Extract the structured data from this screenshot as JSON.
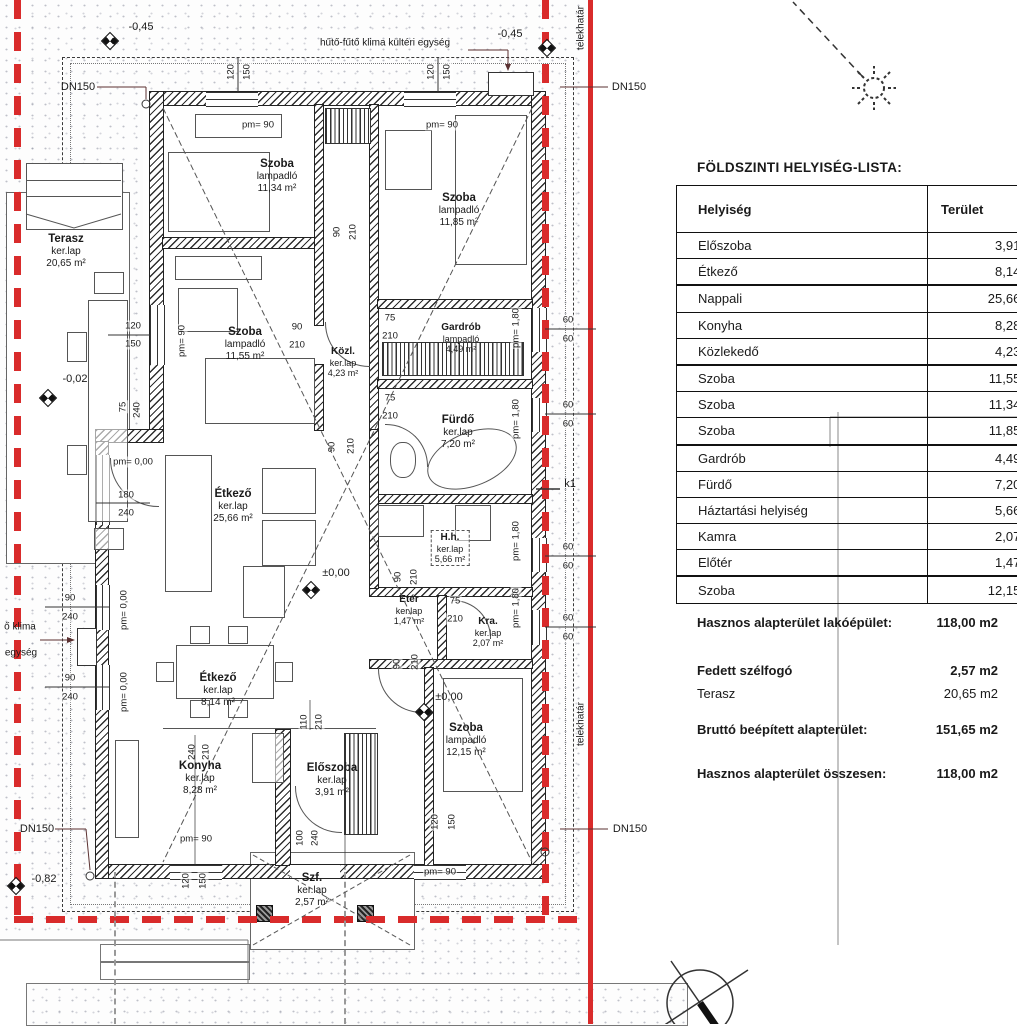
{
  "colors": {
    "boundary_red": "#d92b2b",
    "wall_dark": "#222222",
    "texture_gray": "#737a8a"
  },
  "plan": {
    "rooms": [
      {
        "name": "Terasz",
        "floor": "ker.lap",
        "area": "20,65 m²",
        "x": 66,
        "y": 233,
        "cls": ""
      },
      {
        "name": "Szoba",
        "floor": "lampadló",
        "area": "11,34 m²",
        "x": 277,
        "y": 158,
        "cls": ""
      },
      {
        "name": "Szoba",
        "floor": "lampadló",
        "area": "11,85 m²",
        "x": 459,
        "y": 192,
        "cls": ""
      },
      {
        "name": "Szoba",
        "floor": "lampadló",
        "area": "11,55 m²",
        "x": 245,
        "y": 326,
        "cls": ""
      },
      {
        "name": "Közl.",
        "floor": "ker.lap",
        "area": "4,23 m²",
        "x": 343,
        "y": 346,
        "cls": "sm"
      },
      {
        "name": "Gardrób",
        "floor": "lampadló",
        "area": "4,49 m²",
        "x": 461,
        "y": 322,
        "cls": "sm"
      },
      {
        "name": "Fürdő",
        "floor": "ker.lap",
        "area": "7,20 m²",
        "x": 458,
        "y": 414,
        "cls": ""
      },
      {
        "name": "H.h.",
        "floor": "ker.lap",
        "area": "5,66 m²",
        "x": 450,
        "y": 530,
        "cls": "sm dashedbox"
      },
      {
        "name": "Étkező",
        "floor": "ker.lap",
        "area": "25,66 m²",
        "x": 233,
        "y": 488,
        "cls": ""
      },
      {
        "name": "Etér",
        "floor": "ker.lap",
        "area": "1,47 m²",
        "x": 409,
        "y": 594,
        "cls": "sm"
      },
      {
        "name": "Kra.",
        "floor": "ker.lap",
        "area": "2,07 m²",
        "x": 488,
        "y": 616,
        "cls": "sm"
      },
      {
        "name": "Étkező",
        "floor": "ker.lap",
        "area": "8,14 m²",
        "x": 218,
        "y": 672,
        "cls": ""
      },
      {
        "name": "Konyha",
        "floor": "ker.lap",
        "area": "8,28 m²",
        "x": 200,
        "y": 760,
        "cls": ""
      },
      {
        "name": "Előszoba",
        "floor": "ker.lap",
        "area": "3,91 m²",
        "x": 332,
        "y": 762,
        "cls": ""
      },
      {
        "name": "Szoba",
        "floor": "lampadló",
        "area": "12,15 m²",
        "x": 466,
        "y": 722,
        "cls": ""
      },
      {
        "name": "Szf.",
        "floor": "ker.lap",
        "area": "2,57 m²",
        "x": 312,
        "y": 872,
        "cls": ""
      }
    ],
    "annotations": [
      {
        "t": "hűtő-fűtő klima kültéri egység",
        "x": 385,
        "y": 43,
        "r": 0,
        "cls": "smtxt"
      },
      {
        "t": "DN150",
        "x": 78,
        "y": 87,
        "r": 0,
        "cls": ""
      },
      {
        "t": "DN150",
        "x": 629,
        "y": 87,
        "r": 0,
        "cls": ""
      },
      {
        "t": "DN150",
        "x": 37,
        "y": 829,
        "r": 0,
        "cls": ""
      },
      {
        "t": "DN150",
        "x": 630,
        "y": 829,
        "r": 0,
        "cls": ""
      },
      {
        "t": "-0,45",
        "x": 141,
        "y": 27,
        "r": 0,
        "cls": ""
      },
      {
        "t": "-0,45",
        "x": 510,
        "y": 34,
        "r": 0,
        "cls": ""
      },
      {
        "t": "-0,02",
        "x": 75,
        "y": 379,
        "r": 0,
        "cls": ""
      },
      {
        "t": "-0,82",
        "x": 44,
        "y": 879,
        "r": 0,
        "cls": ""
      },
      {
        "t": "±0,00",
        "x": 336,
        "y": 573,
        "r": 0,
        "cls": ""
      },
      {
        "t": "±0,00",
        "x": 449,
        "y": 697,
        "r": 0,
        "cls": ""
      },
      {
        "t": "k1",
        "x": 570,
        "y": 484,
        "r": 0,
        "cls": ""
      },
      {
        "t": "ő klima",
        "x": 20,
        "y": 627,
        "r": 0,
        "cls": "smtxt"
      },
      {
        "t": "egység",
        "x": 21,
        "y": 653,
        "r": 0,
        "cls": "smtxt"
      },
      {
        "t": "telekhatár",
        "x": 581,
        "y": 724,
        "r": -90,
        "cls": "smtxt"
      },
      {
        "t": "telekhatár",
        "x": 581,
        "y": 28,
        "r": -90,
        "cls": "smtxt"
      }
    ],
    "dims": [
      {
        "t": "120",
        "x": 231,
        "y": 72,
        "r": -90
      },
      {
        "t": "150",
        "x": 247,
        "y": 72,
        "r": -90
      },
      {
        "t": "120",
        "x": 431,
        "y": 72,
        "r": -90
      },
      {
        "t": "150",
        "x": 447,
        "y": 72,
        "r": -90
      },
      {
        "t": "pm= 90",
        "x": 258,
        "y": 125,
        "r": 0
      },
      {
        "t": "pm= 90",
        "x": 442,
        "y": 125,
        "r": 0
      },
      {
        "t": "90",
        "x": 337,
        "y": 232,
        "r": -90
      },
      {
        "t": "210",
        "x": 353,
        "y": 232,
        "r": -90
      },
      {
        "t": "90",
        "x": 297,
        "y": 327,
        "r": 0
      },
      {
        "t": "210",
        "x": 297,
        "y": 345,
        "r": 0
      },
      {
        "t": "75",
        "x": 390,
        "y": 318,
        "r": 0
      },
      {
        "t": "210",
        "x": 390,
        "y": 336,
        "r": 0
      },
      {
        "t": "75",
        "x": 390,
        "y": 398,
        "r": 0
      },
      {
        "t": "210",
        "x": 390,
        "y": 416,
        "r": 0
      },
      {
        "t": "90",
        "x": 332,
        "y": 447,
        "r": -90
      },
      {
        "t": "210",
        "x": 351,
        "y": 446,
        "r": -90
      },
      {
        "t": "90",
        "x": 398,
        "y": 577,
        "r": -90
      },
      {
        "t": "210",
        "x": 414,
        "y": 577,
        "r": -90
      },
      {
        "t": "90",
        "x": 397,
        "y": 664,
        "r": -90
      },
      {
        "t": "210",
        "x": 415,
        "y": 662,
        "r": -90
      },
      {
        "t": "75",
        "x": 455,
        "y": 601,
        "r": 0
      },
      {
        "t": "210",
        "x": 455,
        "y": 619,
        "r": 0
      },
      {
        "t": "pm= 90",
        "x": 182,
        "y": 341,
        "r": -90
      },
      {
        "t": "120",
        "x": 133,
        "y": 326,
        "r": 0
      },
      {
        "t": "150",
        "x": 133,
        "y": 344,
        "r": 0
      },
      {
        "t": "75",
        "x": 123,
        "y": 407,
        "r": -90
      },
      {
        "t": "240",
        "x": 137,
        "y": 410,
        "r": -90
      },
      {
        "t": "pm= 0,00",
        "x": 133,
        "y": 462,
        "r": 0
      },
      {
        "t": "180",
        "x": 126,
        "y": 495,
        "r": 0
      },
      {
        "t": "240",
        "x": 126,
        "y": 513,
        "r": 0
      },
      {
        "t": "90",
        "x": 70,
        "y": 598,
        "r": 0
      },
      {
        "t": "240",
        "x": 70,
        "y": 617,
        "r": 0
      },
      {
        "t": "pm= 0,00",
        "x": 124,
        "y": 610,
        "r": -90
      },
      {
        "t": "90",
        "x": 70,
        "y": 678,
        "r": 0
      },
      {
        "t": "240",
        "x": 70,
        "y": 697,
        "r": 0
      },
      {
        "t": "pm= 0,00",
        "x": 124,
        "y": 692,
        "r": -90
      },
      {
        "t": "240",
        "x": 192,
        "y": 752,
        "r": -90
      },
      {
        "t": "210",
        "x": 206,
        "y": 752,
        "r": -90
      },
      {
        "t": "110",
        "x": 304,
        "y": 722,
        "r": -90
      },
      {
        "t": "210",
        "x": 319,
        "y": 722,
        "r": -90
      },
      {
        "t": "100",
        "x": 300,
        "y": 838,
        "r": -90
      },
      {
        "t": "240",
        "x": 315,
        "y": 838,
        "r": -90
      },
      {
        "t": "120",
        "x": 186,
        "y": 881,
        "r": -90
      },
      {
        "t": "150",
        "x": 203,
        "y": 881,
        "r": -90
      },
      {
        "t": "120",
        "x": 435,
        "y": 822,
        "r": -90
      },
      {
        "t": "150",
        "x": 452,
        "y": 822,
        "r": -90
      },
      {
        "t": "pm= 90",
        "x": 196,
        "y": 839,
        "r": 0
      },
      {
        "t": "pm= 90",
        "x": 440,
        "y": 872,
        "r": 0
      },
      {
        "t": "pm= 1,80",
        "x": 516,
        "y": 328,
        "r": -90
      },
      {
        "t": "pm= 1,80",
        "x": 516,
        "y": 419,
        "r": -90
      },
      {
        "t": "pm= 1,80",
        "x": 516,
        "y": 541,
        "r": -90
      },
      {
        "t": "pm= 1,80",
        "x": 516,
        "y": 608,
        "r": -90
      },
      {
        "t": "60",
        "x": 568,
        "y": 320,
        "r": 0
      },
      {
        "t": "60",
        "x": 568,
        "y": 339,
        "r": 0
      },
      {
        "t": "60",
        "x": 568,
        "y": 405,
        "r": 0
      },
      {
        "t": "60",
        "x": 568,
        "y": 424,
        "r": 0
      },
      {
        "t": "60",
        "x": 568,
        "y": 547,
        "r": 0
      },
      {
        "t": "60",
        "x": 568,
        "y": 566,
        "r": 0
      },
      {
        "t": "60",
        "x": 568,
        "y": 618,
        "r": 0
      },
      {
        "t": "60",
        "x": 568,
        "y": 637,
        "r": 0
      }
    ]
  },
  "table": {
    "title": "FÖLDSZINTI HELYISÉG-LISTA:",
    "col_room": "Helyiség",
    "col_area": "Terület",
    "rows": [
      {
        "name": "Előszoba",
        "area": "3,91 m2",
        "thick": false
      },
      {
        "name": "Étkező",
        "area": "8,14 m2",
        "thick": true
      },
      {
        "name": "Nappali",
        "area": "25,66 m2",
        "thick": false
      },
      {
        "name": "Konyha",
        "area": "8,28 m2",
        "thick": false
      },
      {
        "name": "Közlekedő",
        "area": "4,23 m2",
        "thick": true
      },
      {
        "name": "Szoba",
        "area": "11,55 m2",
        "thick": false
      },
      {
        "name": "Szoba",
        "area": "11,34 m2",
        "thick": false
      },
      {
        "name": "Szoba",
        "area": "11,85 m2",
        "thick": true
      },
      {
        "name": "Gardrób",
        "area": "4,49 m2",
        "thick": false
      },
      {
        "name": "Fürdő",
        "area": "7,20 m2",
        "thick": false
      },
      {
        "name": "Háztartási helyiség",
        "area": "5,66 m2",
        "thick": false
      },
      {
        "name": "Kamra",
        "area": "2,07 m2",
        "thick": false
      },
      {
        "name": "Előtér",
        "area": "1,47 m2",
        "thick": true
      },
      {
        "name": "Szoba",
        "area": "12,15 m2",
        "thick": false
      }
    ],
    "summary": [
      {
        "label": "Hasznos alapterület lakóépület:",
        "value": "118,00 m2",
        "bold": true,
        "y": 615
      },
      {
        "label": "Fedett szélfogó",
        "value": "2,57 m2",
        "bold": true,
        "y": 663
      },
      {
        "label": "Terasz",
        "value": "20,65 m2",
        "bold": false,
        "y": 686
      },
      {
        "label": "Bruttó beépített alapterület:",
        "value": "151,65 m2",
        "bold": true,
        "y": 722
      },
      {
        "label": "Hasznos alapterület összesen:",
        "value": "118,00 m2",
        "bold": true,
        "y": 766
      }
    ]
  }
}
